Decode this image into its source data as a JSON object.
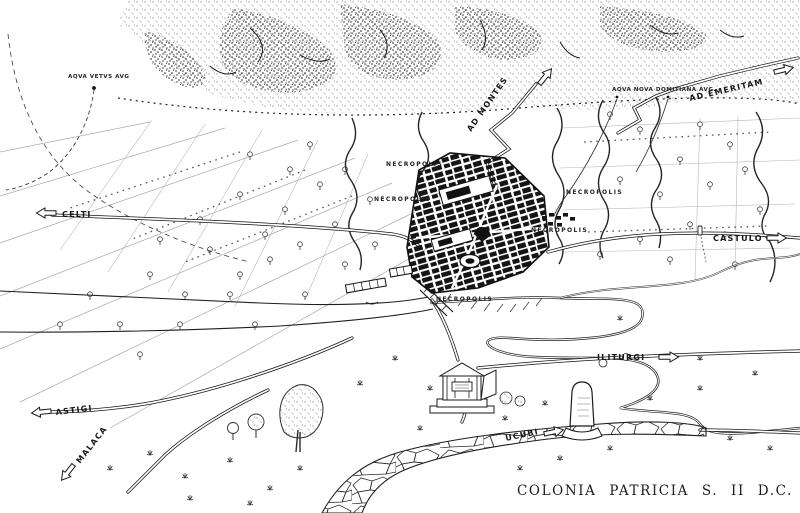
{
  "map": {
    "caption": "COLONIA PATRICIA S. II D.C.",
    "colors": {
      "paper": "#ffffff",
      "ink": "#1b1b1b"
    },
    "labels": {
      "aqua_vetus": "AQVA VETVS AVG",
      "ad_montes": "AD MONTES",
      "aqua_nova_domitiana": "AQVA NOVA DOMITIANA AVG.",
      "ad_emeritam": "AD EMERITAM",
      "celti": "CELTI",
      "castulo": "CASTULO",
      "iliturgi": "ILITURGI",
      "astigi": "ASTIGI",
      "malaca": "MALACA",
      "ucubi": "UCUBI",
      "necropolis_northwest": "NECROPOLIS",
      "necropolis_west": "NECROPOLIS",
      "necropolis_northeast": "NECROPOLIS",
      "necropolis_east": "NECROPOLIS",
      "necropolis_south": "NECROPOLIS"
    }
  }
}
